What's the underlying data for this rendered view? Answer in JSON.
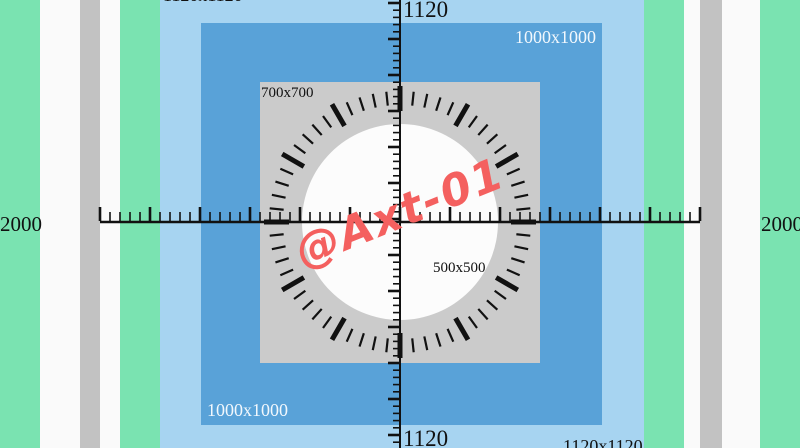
{
  "colors": {
    "mint": "#7ae3b1",
    "stripe_white": "#fafafa",
    "stripe_gray": "#c2c2c2",
    "light_blue": "#a7d4f1",
    "blue": "#59a2d8",
    "square_gray": "#cbcbcb",
    "circle_white": "#fcfcfc",
    "ink": "#111111",
    "watermark_red": "#f4605f"
  },
  "labels": {
    "outer_top_left": "1120x1120",
    "outer_bottom_right": "1120x1120",
    "vruler_top": "1120",
    "vruler_bottom": "1120",
    "hruler_left": "2000",
    "hruler_right": "2000",
    "blue_top_right": "1000x1000",
    "blue_bottom_left": "1000x1000",
    "gray_square": "700x700",
    "circle": "500x500",
    "watermark": "@Axt-01"
  },
  "dial": {
    "minor_ticks": 60,
    "major_every": 5
  },
  "rulers": {
    "horizontal_span_label": "2000",
    "vertical_span_label": "1120"
  }
}
